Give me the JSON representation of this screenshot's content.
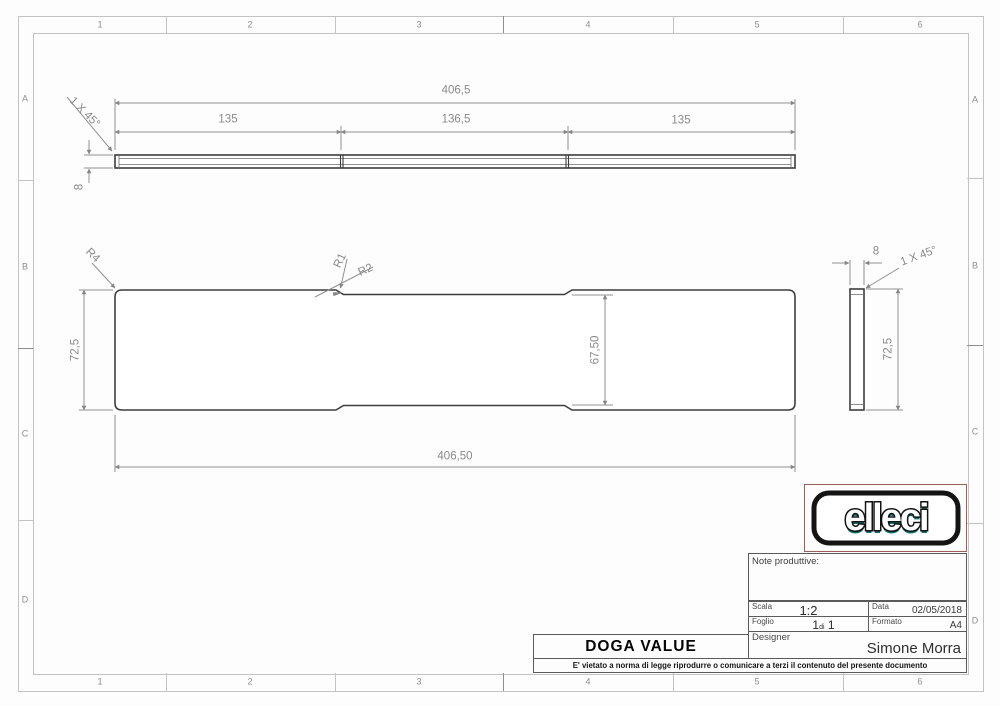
{
  "frame": {
    "columns": [
      "1",
      "2",
      "3",
      "4",
      "5",
      "6"
    ],
    "rows": [
      "A",
      "B",
      "C",
      "D"
    ]
  },
  "views": {
    "front": {
      "overall_length": "406,5",
      "segment_left": "135",
      "segment_mid": "136,5",
      "segment_right": "135",
      "chamfer": "1 X 45°",
      "thickness": "8"
    },
    "plan": {
      "corner_radius": "R4",
      "step_radius_1": "R1",
      "step_radius_2": "R2",
      "end_height": "72,5",
      "mid_height": "67,50",
      "overall_length": "406,50"
    },
    "side": {
      "width": "8",
      "chamfer": "1 X 45°",
      "height": "72,5"
    }
  },
  "title_block": {
    "logo_text": "elleci",
    "note_label": "Note produttive:",
    "scala_label": "Scala",
    "scala_value": "1:2",
    "data_label": "Data",
    "data_value": "02/05/2018",
    "foglio_label": "Foglio",
    "foglio_value_pre": "1",
    "foglio_value_di": "di",
    "foglio_value_post": "1",
    "formato_label": "Formato",
    "formato_value": "A4",
    "designer_label": "Designer",
    "designer_value": "Simone Morra",
    "part_title": "DOGA VALUE",
    "disclaimer": "E' vietato a norma di legge riprodurre o comunicare a terzi il contenuto del presente documento"
  },
  "colors": {
    "part_line": "#3d3d3d",
    "dim_line": "#919191",
    "frame_line": "#c3c3c3",
    "logo_teal": "#0e6e6e",
    "logo_frame_red": "#9b5f57"
  }
}
